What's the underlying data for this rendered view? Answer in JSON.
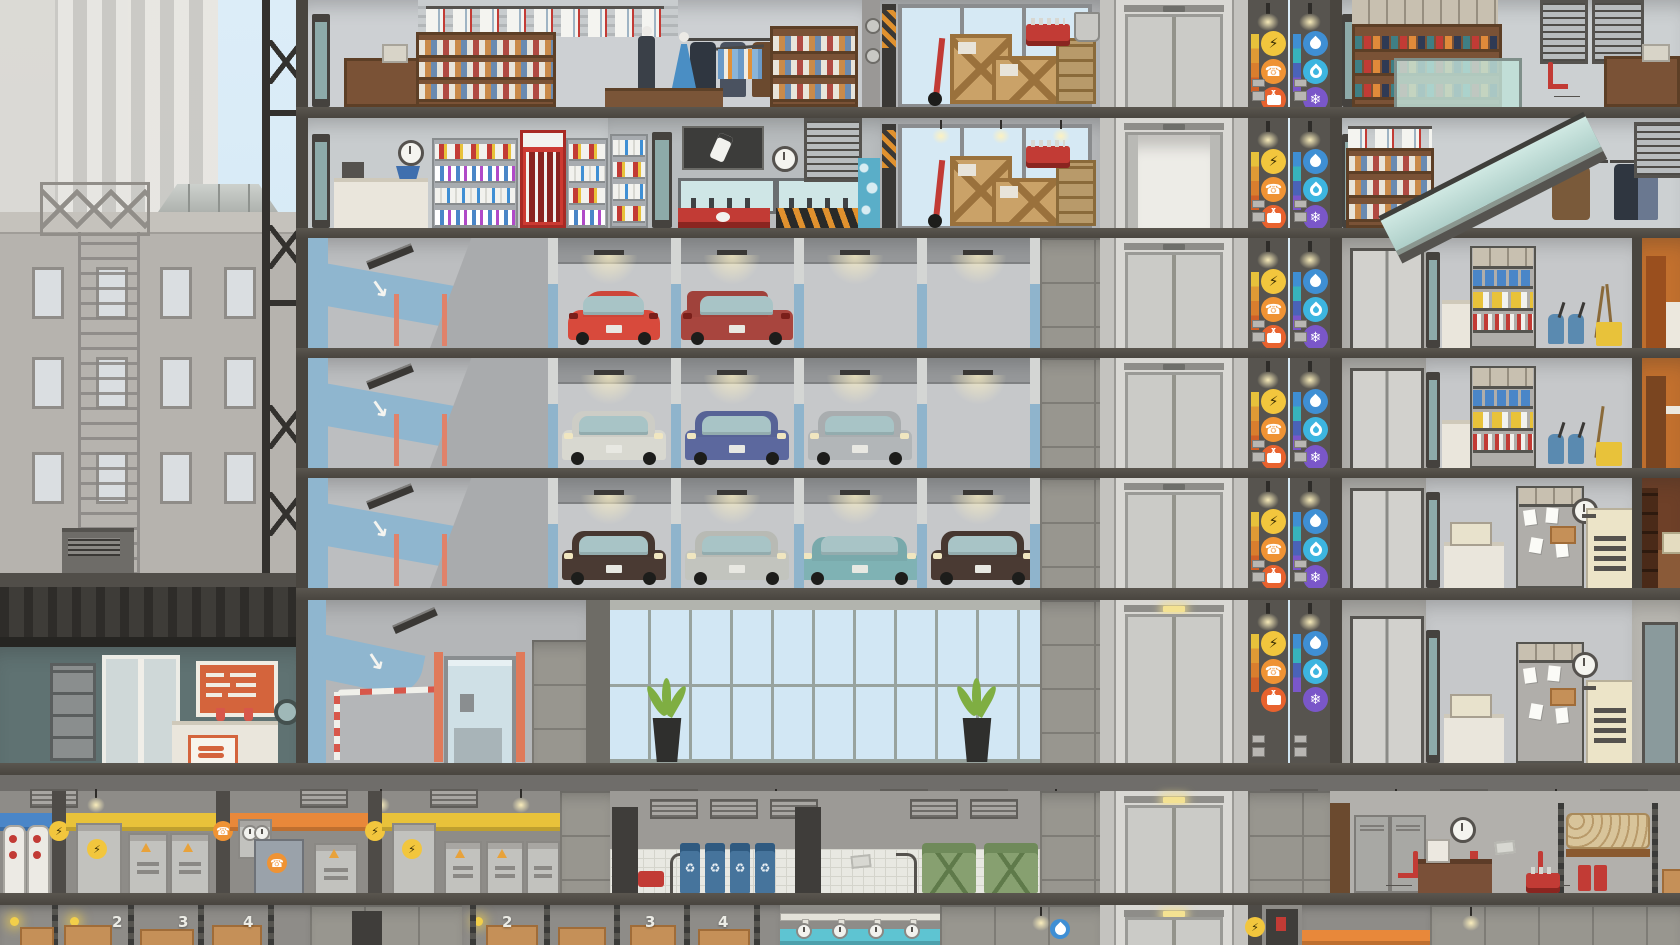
{
  "scene": {
    "kind": "skyscraper-cross-section",
    "floors_visible": 8
  },
  "icons": {
    "electricity": {
      "glyph": "⚡",
      "color": "#f2c63d",
      "fg": "#3a2f05"
    },
    "phone": {
      "glyph": "☎",
      "color": "#ef9334",
      "fg": "#ffffff"
    },
    "cable_tv": {
      "glyph": "tv",
      "color": "#e8622e",
      "fg": "#ffffff"
    },
    "water": {
      "glyph": "drop",
      "color": "#3f8fd4",
      "fg": "#ffffff"
    },
    "gas": {
      "glyph": "flame",
      "color": "#3db5e0",
      "fg": "#ffffff"
    },
    "hvac": {
      "glyph": "❄",
      "color": "#7a57c9",
      "fg": "#ffffff"
    },
    "recycle": {
      "glyph": "♻",
      "color": "#46749c",
      "fg": "#e8eef2"
    }
  },
  "utility_shafts": {
    "left_services": [
      "electricity",
      "phone",
      "cable_tv"
    ],
    "right_services": [
      "water",
      "gas",
      "hvac"
    ]
  },
  "floors": [
    {
      "label": "retail-upper",
      "rooms": [
        "clothing-store",
        "workshop-storage",
        "elevator",
        "utility-shafts",
        "shoe-store"
      ]
    },
    {
      "label": "retail-lower",
      "rooms": [
        "convenience-store",
        "phone-store",
        "workshop-storage",
        "elevator",
        "utility-shafts",
        "clothing-store-lower"
      ]
    },
    {
      "label": "parking-3",
      "rooms": [
        "parking-ramp",
        "parking-stalls",
        "elevator",
        "utility-shafts",
        "janitor-closet",
        "cafe-corner"
      ]
    },
    {
      "label": "parking-2",
      "rooms": [
        "parking-ramp",
        "parking-stalls",
        "elevator",
        "utility-shafts",
        "janitor-closet",
        "cafe-corner"
      ]
    },
    {
      "label": "parking-1",
      "rooms": [
        "parking-ramp",
        "parking-stalls",
        "elevator",
        "utility-shafts",
        "copy-room",
        "study"
      ]
    },
    {
      "label": "ground",
      "rooms": [
        "fast-food-restaurant",
        "parking-entrance",
        "glass-lobby",
        "elevator",
        "utility-shafts",
        "copy-room",
        "office-door"
      ]
    },
    {
      "label": "basement-1",
      "rooms": [
        "water-plant",
        "electrical-room",
        "telecom-room",
        "electrical-room-2",
        "trash-room",
        "elevator",
        "break-room"
      ]
    },
    {
      "label": "basement-2",
      "rooms": [
        "storage-room-a",
        "storage-room-b",
        "water-pumps",
        "elevator",
        "utility-room"
      ]
    }
  ],
  "parking": {
    "stalls_per_level": 4,
    "levels": [
      {
        "name": "parking-3",
        "cars": [
          {
            "stall": 1,
            "color": "#d84a3c",
            "body": "beetle",
            "view": "rear"
          },
          {
            "stall": 2,
            "color": "#a8453e",
            "body": "wagon",
            "view": "rear"
          }
        ]
      },
      {
        "name": "parking-2",
        "cars": [
          {
            "stall": 1,
            "color": "#d8d8d0",
            "body": "sedan",
            "view": "front"
          },
          {
            "stall": 2,
            "color": "#5c689e",
            "body": "sedan",
            "view": "front"
          },
          {
            "stall": 3,
            "color": "#b2b6b8",
            "body": "sedan",
            "view": "front"
          }
        ]
      },
      {
        "name": "parking-1",
        "cars": [
          {
            "stall": 1,
            "color": "#4a3a33",
            "body": "sedan",
            "view": "front"
          },
          {
            "stall": 2,
            "color": "#c2c4be",
            "body": "sedan",
            "view": "front"
          },
          {
            "stall": 3,
            "color": "#7fb2b4",
            "body": "cadillac",
            "view": "front"
          },
          {
            "stall": 4,
            "color": "#4a3a33",
            "body": "sedan",
            "view": "front"
          }
        ]
      }
    ]
  },
  "storage": {
    "room_a_bins": [
      "2",
      "3",
      "4"
    ],
    "room_b_bins": [
      "2",
      "3",
      "4"
    ]
  },
  "palette": {
    "sky": "#d8ebf6",
    "slab": "#49453f",
    "room_gray": "#c9cccf",
    "parking_post_blue": "#8fb4cc",
    "lobby_glass": "#cfe0da",
    "stripe_electric": "#e8c23a",
    "stripe_telecom": "#e8883a",
    "stripe_water": "#4a86c8",
    "stripe_pump": "#5ec4d2",
    "bin_blue": "#46749c",
    "dumpster_green": "#87a070",
    "worker_uniform_red": "#c8372e",
    "chair_red": "#c23b35"
  }
}
